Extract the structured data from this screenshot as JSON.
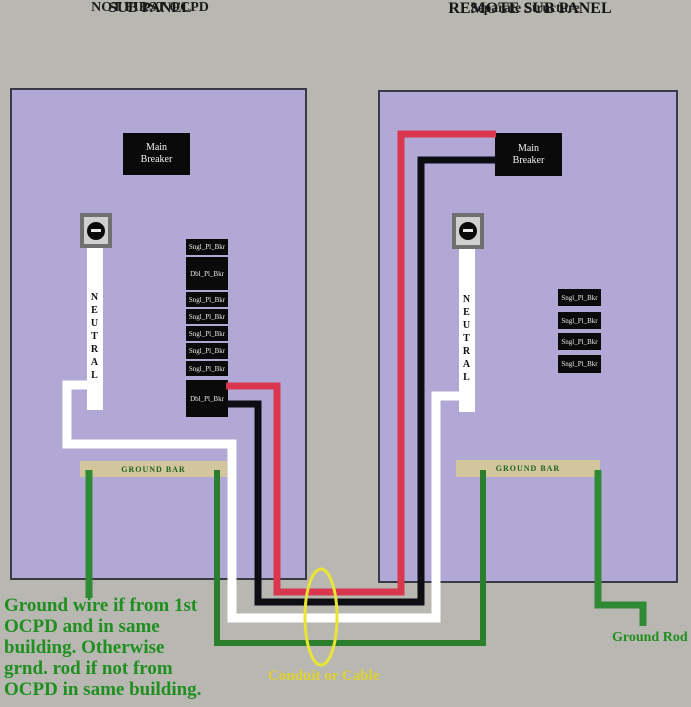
{
  "titles": {
    "left": {
      "line1": "SUB PANEL",
      "line2": "NOT FIRST OCPD"
    },
    "right": {
      "line1": "REMOTE SUB PANEL",
      "line2": "Separate Structure"
    }
  },
  "left_panel": {
    "main_breaker_label": "Main Breaker",
    "neutral_label": "NEUTRAL",
    "ground_bar_label": "GROUND BAR",
    "breakers": [
      "Sngl_Pl_Bkr",
      "Dbl_Pl_Bkr",
      "Sngl_Pl_Bkr",
      "Sngl_Pl_Bkr",
      "Sngl_Pl_Bkr",
      "Sngl_Pl_Bkr",
      "Sngl_Pl_Bkr",
      "Dbl_Pl_Bkr"
    ]
  },
  "right_panel": {
    "main_breaker_label": "Main Breaker",
    "neutral_label": "NEUTRAL",
    "ground_bar_label": "GROUND BAR",
    "breakers": [
      "Sngl_Pl_Bkr",
      "Sngl_Pl_Bkr",
      "Sngl_Pl_Bkr",
      "Sngl_Pl_Bkr"
    ]
  },
  "annotations": {
    "conduit_label": "Conduit or Cable",
    "ground_rod_label": "Ground Rod",
    "ground_note_lines": [
      "Ground wire if from 1st",
      "OCPD and in same",
      "building. Otherwise",
      "grnd. rod if not from",
      "OCPD in same building."
    ]
  },
  "colors": {
    "background": "#b8b7b2",
    "panel_fill": "#b2a8d6",
    "panel_border": "#3a3a46",
    "breaker_box": "#0a0a0a",
    "breaker_text": "#ffffff",
    "ground_bar_fill": "#d4c69c",
    "ground_bar_text": "#1d661d",
    "wire_red": "#d8374e",
    "wire_black": "#0d0d14",
    "wire_white": "#ffffff",
    "wire_green": "#2e8b34",
    "conduit_yellow": "#e9e436",
    "note_green": "#1f8f1f"
  }
}
